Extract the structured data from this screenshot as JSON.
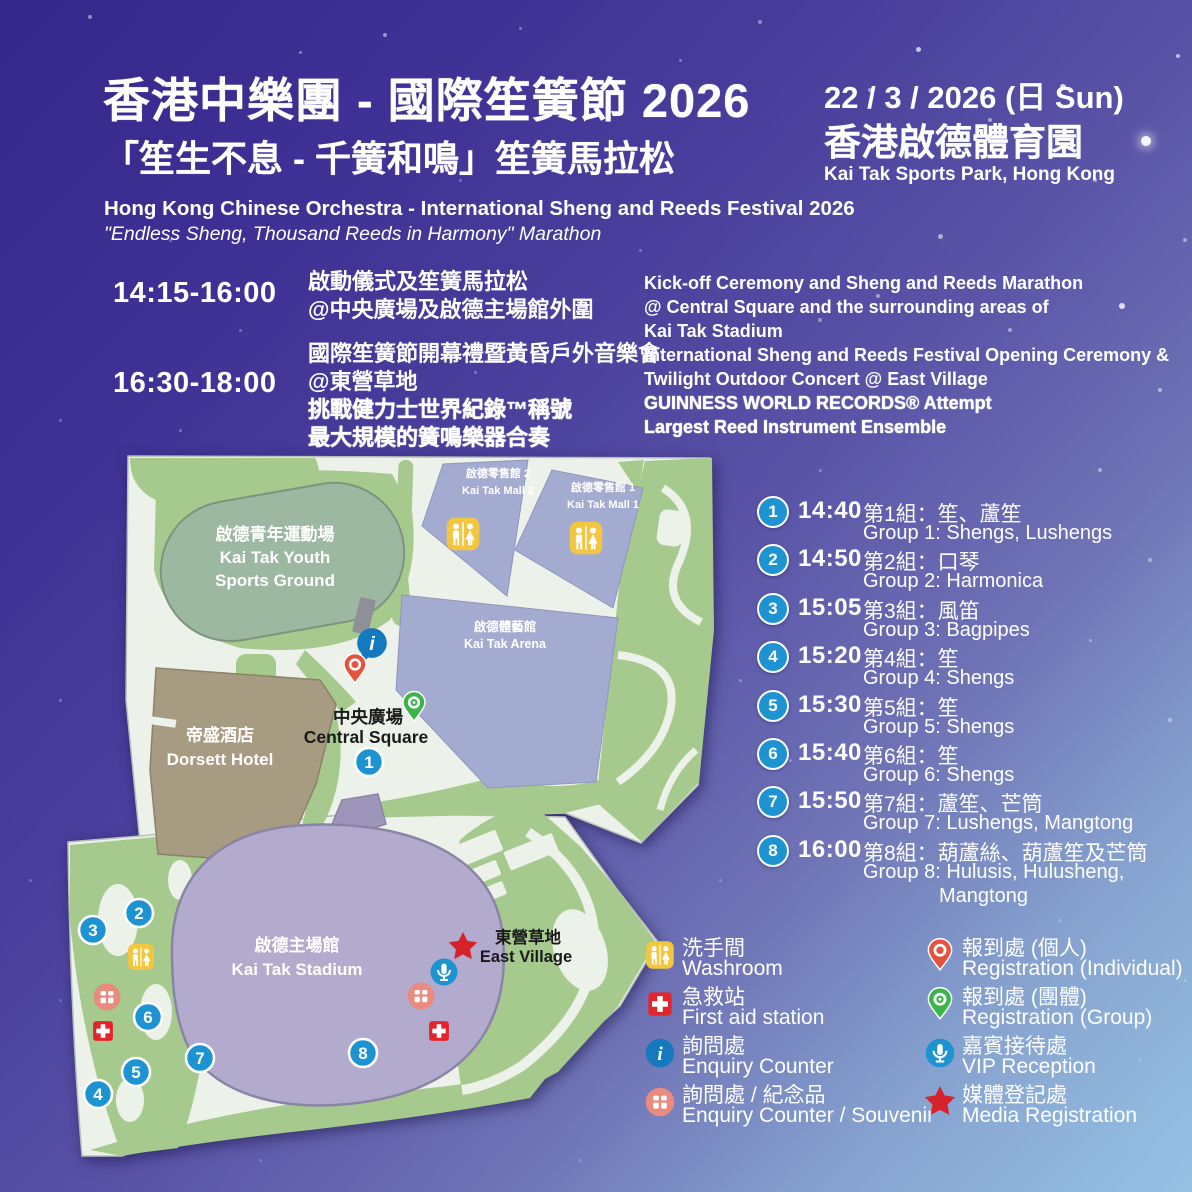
{
  "header": {
    "title_zh": "香港中樂團 - 國際笙簧節 2026",
    "subtitle_zh": "「笙生不息 - 千簧和鳴」笙簧馬拉松",
    "title_en": "Hong Kong Chinese Orchestra - International Sheng and Reeds Festival 2026",
    "subtitle_en": "\"Endless Sheng, Thousand Reeds in Harmony\" Marathon",
    "date": "22 / 3 / 2026 (日 Sun)",
    "venue_zh": "香港啟德體育園",
    "venue_en": "Kai Tak Sports Park, Hong Kong"
  },
  "schedule": [
    {
      "time": "14:15-16:00",
      "zh_lines": [
        "啟動儀式及笙簧馬拉松",
        "@中央廣場及啟德主場館外圍"
      ],
      "zh_bold": [],
      "en_lines": [
        "Kick-off Ceremony and Sheng and Reeds Marathon",
        "@ Central Square and the surrounding areas of",
        "Kai Tak Stadium"
      ],
      "en_bold": []
    },
    {
      "time": "16:30-18:00",
      "zh_lines": [
        "國際笙簧節開幕禮暨黃昏戶外音樂會",
        "@東營草地",
        "挑戰健力士世界紀錄™稱號",
        "最大規模的簧鳴樂器合奏"
      ],
      "zh_bold": [
        2,
        3
      ],
      "en_lines": [
        "International Sheng and Reeds Festival Opening Ceremony &",
        "Twilight Outdoor Concert @ East Village",
        "GUINNESS WORLD RECORDS® Attempt",
        "Largest Reed Instrument Ensemble"
      ],
      "en_bold": [
        2,
        3
      ]
    }
  ],
  "groups": [
    {
      "num": "1",
      "time": "14:40",
      "zh": "第1組：笙、蘆笙",
      "en": "Group 1: Shengs, Lushengs"
    },
    {
      "num": "2",
      "time": "14:50",
      "zh": "第2組：口琴",
      "en": "Group 2: Harmonica"
    },
    {
      "num": "3",
      "time": "15:05",
      "zh": "第3組：風笛",
      "en": "Group 3: Bagpipes"
    },
    {
      "num": "4",
      "time": "15:20",
      "zh": "第4組：笙",
      "en": "Group 4: Shengs"
    },
    {
      "num": "5",
      "time": "15:30",
      "zh": "第5組：笙",
      "en": "Group 5: Shengs"
    },
    {
      "num": "6",
      "time": "15:40",
      "zh": "第6組：笙",
      "en": "Group 6: Shengs"
    },
    {
      "num": "7",
      "time": "15:50",
      "zh": "第7組：蘆笙、芒筒",
      "en": "Group 7: Lushengs, Mangtong"
    },
    {
      "num": "8",
      "time": "16:00",
      "zh": "第8組：葫蘆絲、葫蘆笙及芒筒",
      "en": "Group 8: Hulusis, Hulusheng,",
      "en2": "Mangtong"
    }
  ],
  "legend": {
    "left": [
      {
        "icon": "washroom-icon",
        "kind": "washroom",
        "zh": "洗手間",
        "en": "Washroom"
      },
      {
        "icon": "first-aid-icon",
        "kind": "firstaid",
        "zh": "急救站",
        "en": "First aid station"
      },
      {
        "icon": "enquiry-icon",
        "kind": "enquiry",
        "zh": "詢問處",
        "en": "Enquiry Counter"
      },
      {
        "icon": "souvenir-icon",
        "kind": "souvenir",
        "zh": "詢問處 / 紀念品",
        "en": "Enquiry Counter / Souvenir"
      }
    ],
    "right": [
      {
        "icon": "pin-red-icon",
        "kind": "pin_red",
        "zh": "報到處 (個人)",
        "en": "Registration (Individual)"
      },
      {
        "icon": "pin-green-icon",
        "kind": "pin_green",
        "zh": "報到處 (團體)",
        "en": "Registration (Group)"
      },
      {
        "icon": "mic-icon",
        "kind": "mic",
        "zh": "嘉賓接待處",
        "en": "VIP Reception"
      },
      {
        "icon": "star-icon",
        "kind": "star",
        "zh": "媒體登記處",
        "en": "Media Registration"
      }
    ]
  },
  "map": {
    "labels": [
      {
        "x": 215,
        "y": 90,
        "t": "啟德青年運動場",
        "c": "#ffffff",
        "s": 17
      },
      {
        "x": 215,
        "y": 113,
        "t": "Kai Tak Youth",
        "c": "#ffffff",
        "s": 17
      },
      {
        "x": 215,
        "y": 136,
        "t": "Sports Ground",
        "c": "#ffffff",
        "s": 17
      },
      {
        "x": 438,
        "y": 27,
        "t": "啟德零售館 2",
        "c": "#ffffff",
        "s": 11
      },
      {
        "x": 438,
        "y": 44,
        "t": "Kai Tak Mall 2",
        "c": "#ffffff",
        "s": 11
      },
      {
        "x": 543,
        "y": 41,
        "t": "啟德零售館 1",
        "c": "#ffffff",
        "s": 11
      },
      {
        "x": 543,
        "y": 58,
        "t": "Kai Tak Mall 1",
        "c": "#ffffff",
        "s": 11
      },
      {
        "x": 445,
        "y": 181,
        "t": "啟德體藝館",
        "c": "#ffffff",
        "s": 12.5
      },
      {
        "x": 445,
        "y": 198,
        "t": "Kai Tak Arena",
        "c": "#ffffff",
        "s": 12.5
      },
      {
        "x": 160,
        "y": 291,
        "t": "帝盛酒店",
        "c": "#ffffff",
        "s": 17
      },
      {
        "x": 160,
        "y": 315,
        "t": "Dorsett Hotel",
        "c": "#ffffff",
        "s": 17
      },
      {
        "x": 308,
        "y": 273,
        "t": "中央廣場",
        "c": "#1a1a1a",
        "s": 17.5
      },
      {
        "x": 306,
        "y": 293,
        "t": "Central Square",
        "c": "#1a1a1a",
        "s": 17.5
      },
      {
        "x": 237,
        "y": 501,
        "t": "啟德主場館",
        "c": "#ffffff",
        "s": 17
      },
      {
        "x": 237,
        "y": 525,
        "t": "Kai Tak Stadium",
        "c": "#ffffff",
        "s": 17
      },
      {
        "x": 468,
        "y": 493,
        "t": "東營草地",
        "c": "#1a1a1a",
        "s": 16.5
      },
      {
        "x": 466,
        "y": 512,
        "t": "East Village",
        "c": "#1a1a1a",
        "s": 16.5
      }
    ],
    "markers": [
      {
        "kind": "badge",
        "n": "1",
        "x": 309,
        "y": 312
      },
      {
        "kind": "badge",
        "n": "2",
        "x": 79,
        "y": 463
      },
      {
        "kind": "badge",
        "n": "3",
        "x": 33,
        "y": 480
      },
      {
        "kind": "badge",
        "n": "4",
        "x": 38,
        "y": 644
      },
      {
        "kind": "badge",
        "n": "5",
        "x": 76,
        "y": 622
      },
      {
        "kind": "badge",
        "n": "6",
        "x": 88,
        "y": 567
      },
      {
        "kind": "badge",
        "n": "7",
        "x": 140,
        "y": 608
      },
      {
        "kind": "badge",
        "n": "8",
        "x": 303,
        "y": 603
      },
      {
        "kind": "washroom",
        "x": 81,
        "y": 507,
        "sc": 1
      },
      {
        "kind": "washroom",
        "x": 403,
        "y": 84,
        "sc": 1.25
      },
      {
        "kind": "washroom",
        "x": 526,
        "y": 88,
        "sc": 1.25
      },
      {
        "kind": "souvenir",
        "x": 47,
        "y": 547,
        "sc": 1
      },
      {
        "kind": "souvenir",
        "x": 361,
        "y": 546,
        "sc": 1
      },
      {
        "kind": "firstaid",
        "x": 43,
        "y": 581,
        "sc": 0.9
      },
      {
        "kind": "firstaid",
        "x": 379,
        "y": 581,
        "sc": 0.9
      },
      {
        "kind": "enquiry",
        "x": 312,
        "y": 193,
        "sc": 1.1,
        "tail": true
      },
      {
        "kind": "pin_red",
        "x": 295,
        "y": 219,
        "sc": 1
      },
      {
        "kind": "pin_green",
        "x": 354,
        "y": 257,
        "sc": 1
      },
      {
        "kind": "mic",
        "x": 384,
        "y": 522,
        "sc": 1
      },
      {
        "kind": "star",
        "x": 403,
        "y": 497,
        "sc": 1
      }
    ]
  },
  "colors": {
    "badge": "#1e93d2",
    "pin_red": "#e6523e",
    "pin_green": "#3bb54a",
    "star": "#d6232b",
    "washroom": "#f2c63e",
    "firstaid": "#e3242b",
    "souvenir": "#e98b7f",
    "enquiry": "#1579bd",
    "text": "#ffffff"
  }
}
